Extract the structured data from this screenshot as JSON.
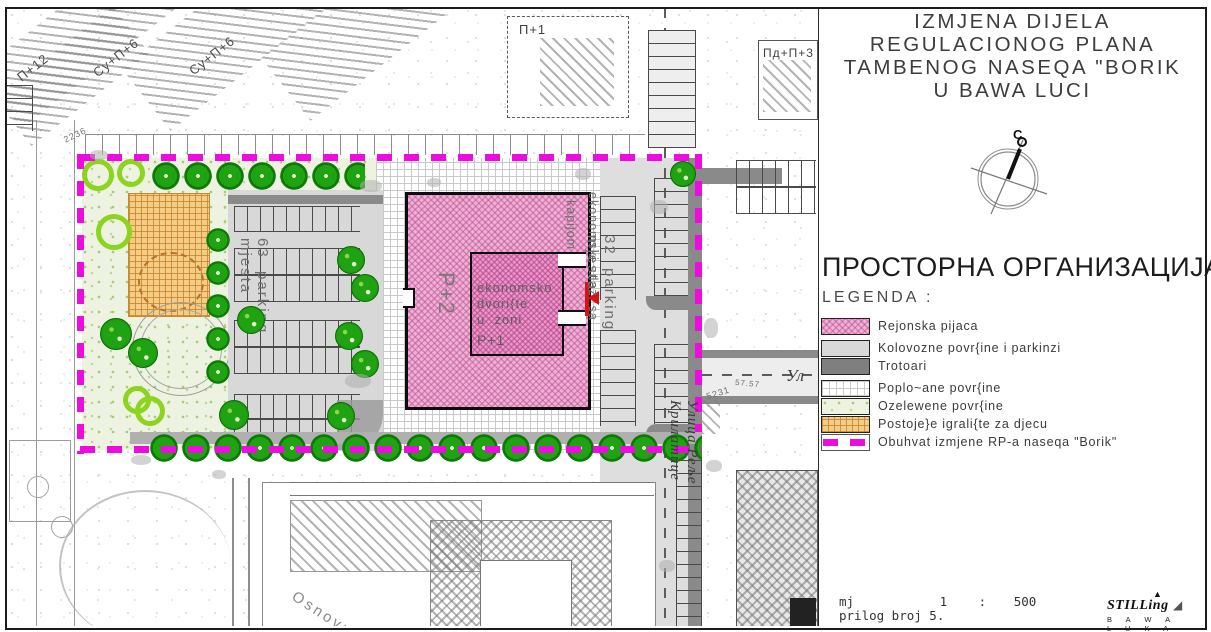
{
  "panel": {
    "title_lines": [
      "IZMJENA DIJELA",
      "REGULACIONOG PLANA",
      "TAMBENOG NASEQA \"BORIK",
      "U BAWA LUCI"
    ],
    "compass_label": "C",
    "heading": "ПРОСТОРНА ОРГАНИЗАЦИЈА",
    "legend_title": "LEGENDA :",
    "legend_items": [
      {
        "label": "Rejonska pijaca",
        "swatch": "pink-crosshatch"
      },
      {
        "label": "Kolovozne povr{ine i parkinzi",
        "swatch": "light-gray"
      },
      {
        "label": "Trotoari",
        "swatch": "dark-gray"
      },
      {
        "label": "Poplo~ane povr{ine",
        "swatch": "white-grid"
      },
      {
        "label": "Ozelewene povr{ine",
        "swatch": "green-speckle"
      },
      {
        "label": "Postoje}e igrali{te za djecu",
        "swatch": "orange-grid"
      },
      {
        "label": "Obuhvat izmjene RP-a naseqa \"Borik\"",
        "swatch": "magenta-dash"
      }
    ],
    "scale_label": "mj",
    "scale_num": "1",
    "scale_colon": ":",
    "scale_den": "500",
    "attachment": "prilog broj 5.",
    "logo_text": "STILLing",
    "logo_sub1": "B  A  W  A",
    "logo_sub2": "L  U  K  A"
  },
  "map": {
    "labels": {
      "b_p12": "П+12",
      "b_sup6a": "Су+П+6",
      "b_sup6b": "Су+П+6",
      "b_p1": "П+1",
      "b_pdp": "Пд+П+3",
      "market_floor": "P+2",
      "courtyard_l1": "ekonomsko",
      "courtyard_l2": "dvori{te",
      "courtyard_l3": "u  zoni",
      "courtyard_l4": "P+1",
      "gate_inner": "kapijom",
      "gate_outer": "ekonomski  ulaz  sa",
      "parking_left_l1": "63  parking",
      "parking_left_l2": "mjesta",
      "parking_right_l1": "32  parking",
      "parking_right_l2": "mjesta",
      "street_v": "Улица Реље Крилатице",
      "street_h": "Ул",
      "school": "Osnovna",
      "num_1": "2236",
      "num_2": "5231",
      "num_3": "57.57"
    },
    "colors": {
      "boundary_magenta": "#EE0BDF",
      "market_pink": "#ECB3D4",
      "playground_orange": "#F3CD86",
      "greenery": "#EEF3E1",
      "tree_green": "#1FA312",
      "road_gray": "#D8D8D8",
      "sidewalk_dark": "#8A8A8A",
      "arrow_red": "#DD1111"
    }
  }
}
